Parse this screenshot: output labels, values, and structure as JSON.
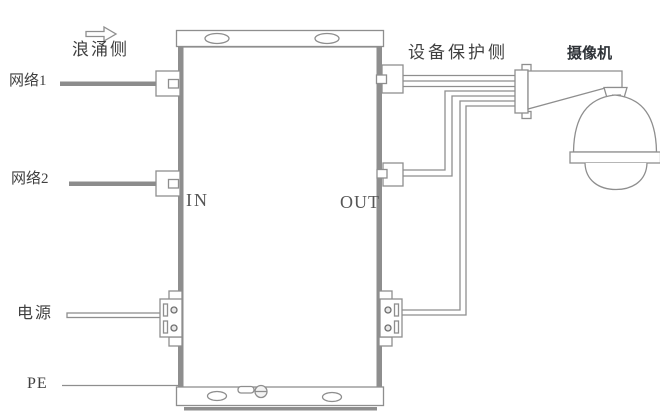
{
  "labels": {
    "surge_side": "浪涌侧",
    "network1": "网络1",
    "network2": "网络2",
    "power": "电源",
    "pe": "PE",
    "in": "IN",
    "out": "OUT",
    "protected_side": "设备保护侧",
    "camera": "摄像机"
  },
  "icons": {
    "flow_arrow": "right-block-arrow-icon",
    "camera_drawing": "dome-camera-illustration"
  },
  "colors": {
    "background": "#ffffff",
    "outline_gray": "#8e8e8e",
    "thick_wire_gray": "#8c8c8c",
    "dark_notch": "#6f6f6f",
    "text": "#3f3f3f",
    "in_out_text": "#565656",
    "camera_label_text": "#2f3338"
  }
}
